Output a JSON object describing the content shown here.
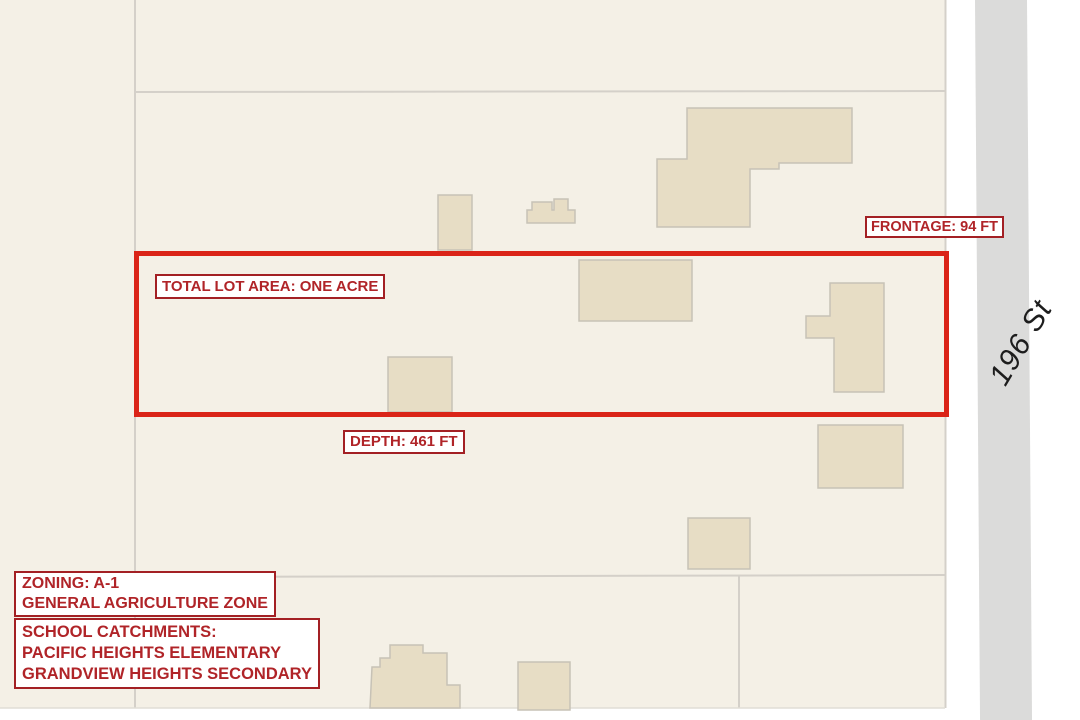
{
  "map_annotations": {
    "lot_area": "TOTAL LOT AREA: ONE ACRE",
    "frontage": "FRONTAGE: 94 FT",
    "depth": "DEPTH: 461 FT",
    "zoning": {
      "line1": "ZONING: A-1",
      "line2": "GENERAL AGRICULTURE ZONE"
    },
    "school": {
      "line1": "SCHOOL CATCHMENTS:",
      "line2": "PACIFIC HEIGHTS ELEMENTARY",
      "line3": "GRANDVIEW HEIGHTS SECONDARY"
    }
  },
  "street_label": "196 St",
  "colors": {
    "parcel_fill": "#f4f0e6",
    "building_fill": "#e7ddc5",
    "building_stroke": "#c7c2b6",
    "parcel_line": "#d4d0c9",
    "road_fill": "#dbdbda",
    "lot_outline_red": "#da2418",
    "annotation_text_red": "#b02428",
    "annotation_border_red": "#a32024",
    "street_text": "#1d1d1d",
    "page_background": "#ffffff"
  }
}
